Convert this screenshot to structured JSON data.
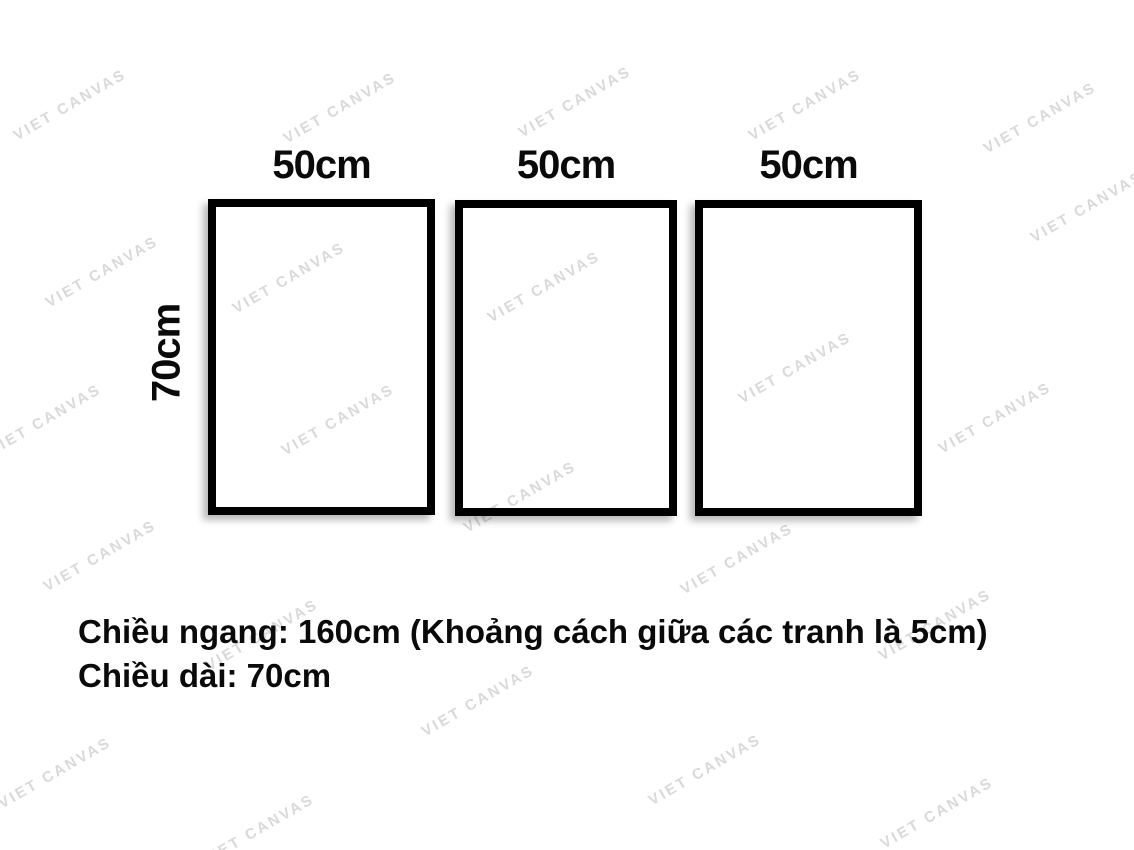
{
  "watermark": {
    "text": "VIET CANVAS"
  },
  "frames": [
    {
      "label": "50cm"
    },
    {
      "label": "50cm"
    },
    {
      "label": "50cm"
    }
  ],
  "side_label": "70cm",
  "caption": {
    "line1": "Chiều ngang: 160cm (Khoảng cách giữa các tranh là 5cm)",
    "line2": "Chiều dài: 70cm"
  },
  "colors": {
    "background": "#ffffff",
    "frame_border": "#000000",
    "text": "#0a0a0a",
    "watermark": "#d9d9d9"
  }
}
